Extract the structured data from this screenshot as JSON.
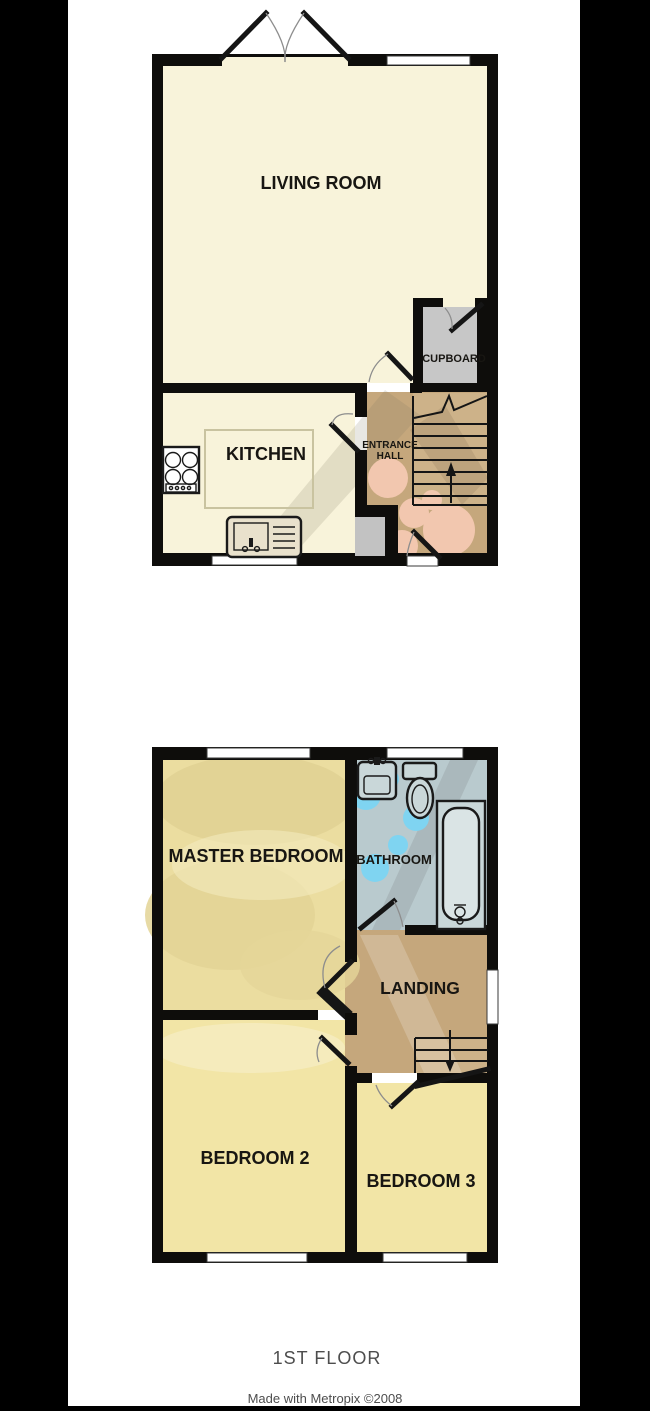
{
  "captions": {
    "floor_label": "1ST FLOOR",
    "credit": "Made with Metropix ©2008"
  },
  "ground_floor": {
    "rooms": {
      "living_room": "LIVING ROOM",
      "kitchen": "KITCHEN",
      "entrance_hall_line1": "ENTRANCE",
      "entrance_hall_line2": "HALL",
      "cupboard": "CUPBOARD"
    }
  },
  "first_floor": {
    "rooms": {
      "master_bedroom": "MASTER BEDROOM",
      "bathroom": "BATHROOM",
      "landing": "LANDING",
      "bedroom_2": "BEDROOM 2",
      "bedroom_3": "BEDROOM 3"
    }
  },
  "colors": {
    "background": "#000000",
    "paper": "#ffffff",
    "wall": "#0e0d0b",
    "cream": "#f8f3da",
    "bedroom_yellow": "#f2e5a6",
    "master_yellow": "#ebdda0",
    "hall_brown": "#c5a77c",
    "stair_brown": "#cdb289",
    "cupboard_grey": "#c7c7c7",
    "recess_grey": "#c2c2c2",
    "bathroom_blue": "#b9cace",
    "fixture_blue": "#c9d7d9",
    "bath_inner": "#dae4e5",
    "watermark_pink": "#f2c7af",
    "watermark_cyan": "#7fd4f1",
    "window_white": "#ffffff",
    "sink_beige": "#e9e1cc",
    "sink_basin": "#d9cfb4",
    "counter_line": "#c9c3a0",
    "caption_grey": "#4d4d4d"
  }
}
